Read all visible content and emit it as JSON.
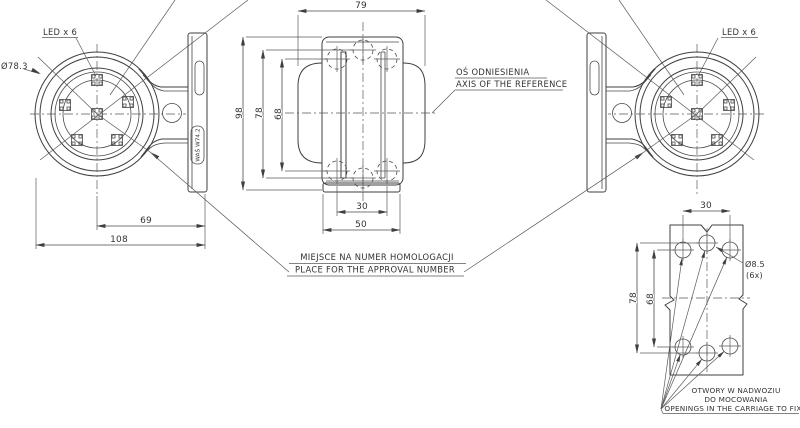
{
  "labels": {
    "led_left": "LED x 6",
    "led_right": "LED x 6",
    "lens_diameter": "Ø78.3",
    "axis_line1": "OŚ ODNIESIENIA",
    "axis_line2": "AXIS OF THE REFERENCE",
    "approval_line1": "MIEJSCE NA NUMER HOMOLOGACJI",
    "approval_line2": "PLACE FOR THE APPROVAL NUMBER",
    "mount_line1": "OTWORY W NADWOZIU",
    "mount_line2": "DO MOCOWANIA",
    "mount_line3": "OPENINGS IN THE CARRIAGE TO FIX",
    "hole_diameter": "Ø8.5",
    "hole_count": "(6x)",
    "approval_mark": "WAŚ W74.2"
  },
  "dimensions": {
    "front_overall_width": "108",
    "front_center_to_bracket": "69",
    "side_depth": "79",
    "side_height": "98",
    "side_center_holes": "78",
    "side_outer_holes": "68",
    "side_slot_width": "30",
    "side_base_width": "50",
    "plate_hole_spacing": "30",
    "plate_center_holes": "78",
    "plate_side_holes": "68"
  },
  "colors": {
    "line": "#3f3f3f",
    "background": "#ffffff"
  }
}
